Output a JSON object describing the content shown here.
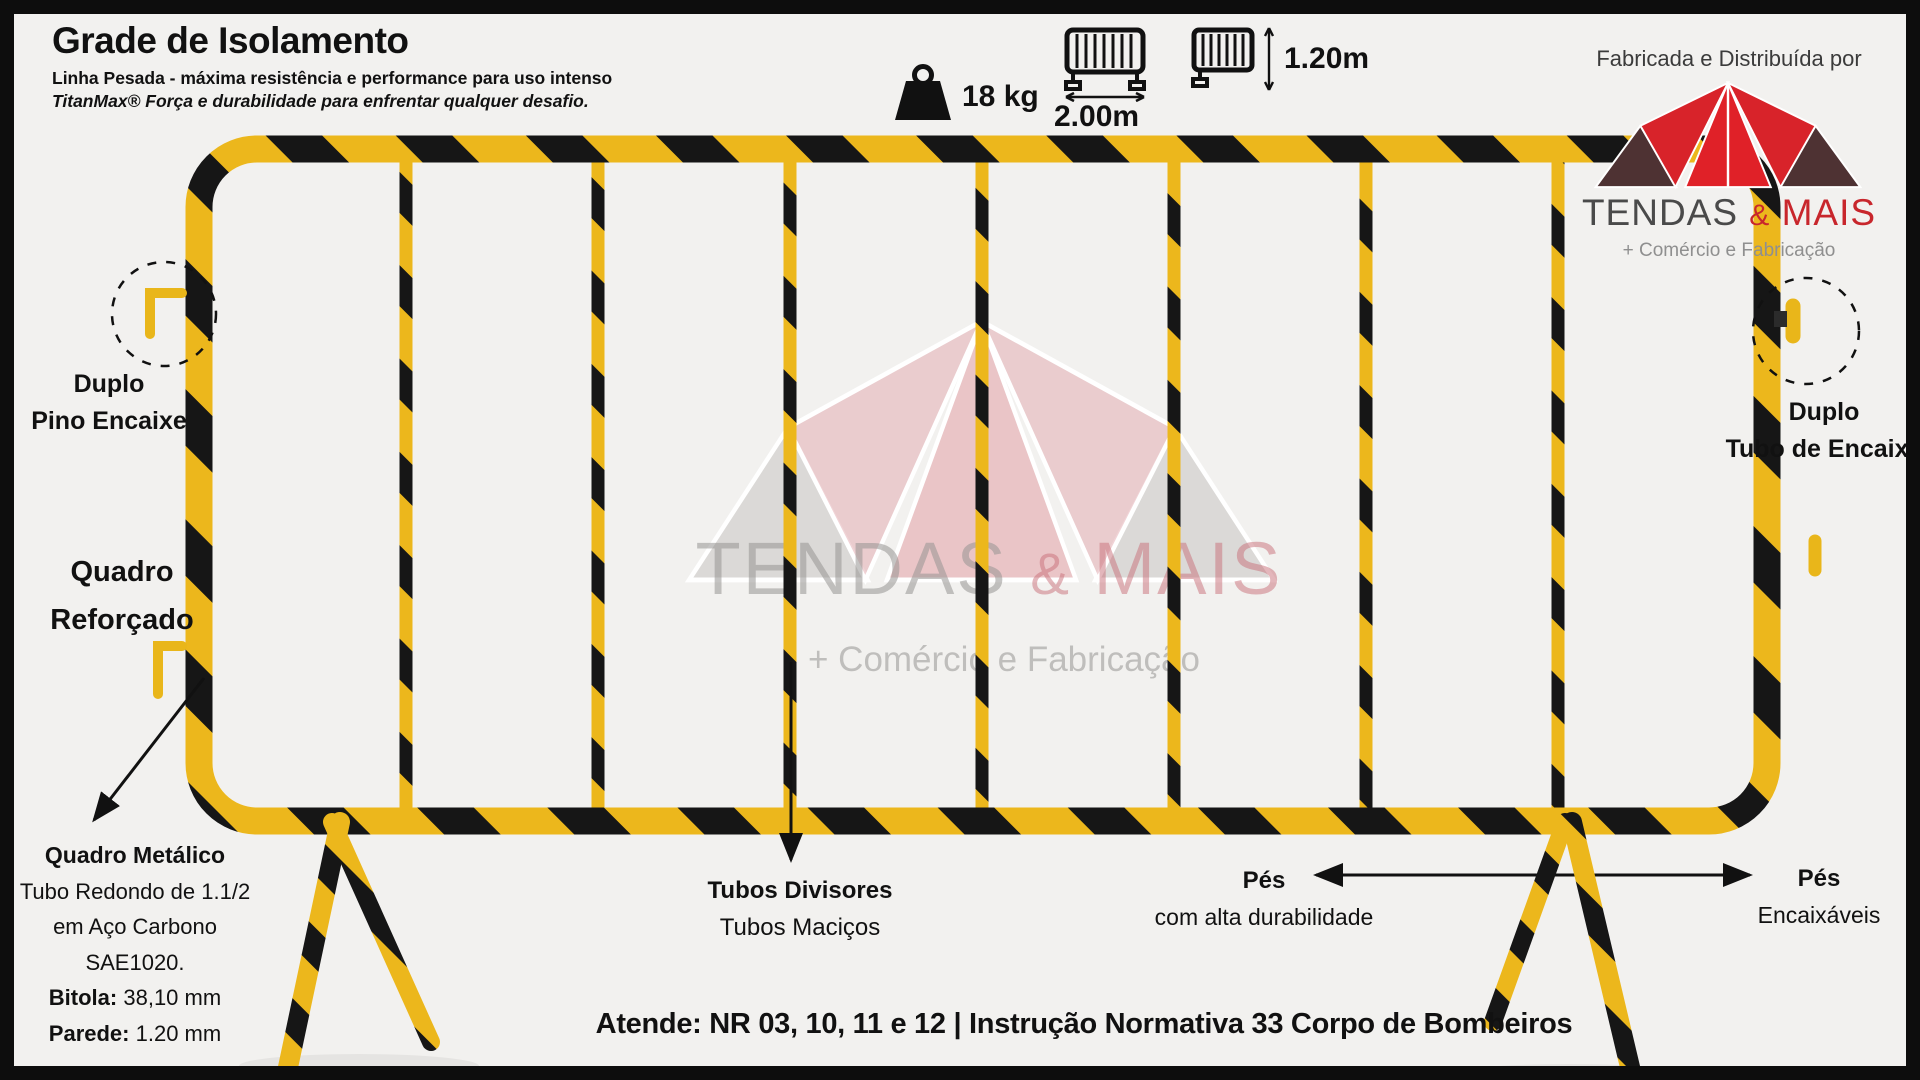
{
  "header": {
    "title": "Grade de Isolamento",
    "subtitle1": "Linha Pesada - máxima resistência e performance para uso intenso",
    "subtitle2": "TitanMax® Força e durabilidade para enfrentar qualquer desafio."
  },
  "specs": {
    "weight": "18 kg",
    "width": "2.00m",
    "height": "1.20m"
  },
  "distributor": {
    "caption": "Fabricada e Distribuída por",
    "brand_primary": "TENDAS",
    "brand_amp": "&",
    "brand_secondary": "MAIS",
    "tagline": "+ Comércio e Fabricação"
  },
  "watermark": {
    "brand_primary": "TENDAS",
    "brand_amp": "&",
    "brand_secondary": "MAIS",
    "tagline": "+ Comércio e Fabricação"
  },
  "annotations": {
    "pin_left_line1": "Duplo",
    "pin_left_line2": "Pino Encaixe",
    "frame_line1": "Quadro",
    "frame_line2": "Reforçado",
    "metal_frame": {
      "heading": "Quadro Metálico",
      "line1": "Tubo Redondo de 1.1/2",
      "line2": "em Aço Carbono",
      "line3": "SAE1020.",
      "line4_label": "Bitola:",
      "line4_value": " 38,10 mm",
      "line5_label": "Parede:",
      "line5_value": " 1.20 mm"
    },
    "dividers_line1": "Tubos Divisores",
    "dividers_line2": "Tubos Maciços",
    "feet_center_line1": "Pés",
    "feet_center_line2": "com alta durabilidade",
    "feet_right_line1": "Pés",
    "feet_right_line2": "Encaixáveis",
    "socket_right_line1": "Duplo",
    "socket_right_line2": "Tubo de Encaixe"
  },
  "footer": {
    "compliance": "Atende: NR 03, 10, 11 e 12  |  Instrução Normativa 33 Corpo de Bombeiros"
  },
  "colors": {
    "barrier_yellow": "#ecb71c",
    "stripe_black": "#161616",
    "brand_red": "#cf2329",
    "brand_dark": "#4e3233",
    "watermark_pink": "#eac3c6",
    "watermark_gray": "#d2d0ce",
    "background": "#f2f1ef",
    "border_black": "#0d0d0d"
  }
}
